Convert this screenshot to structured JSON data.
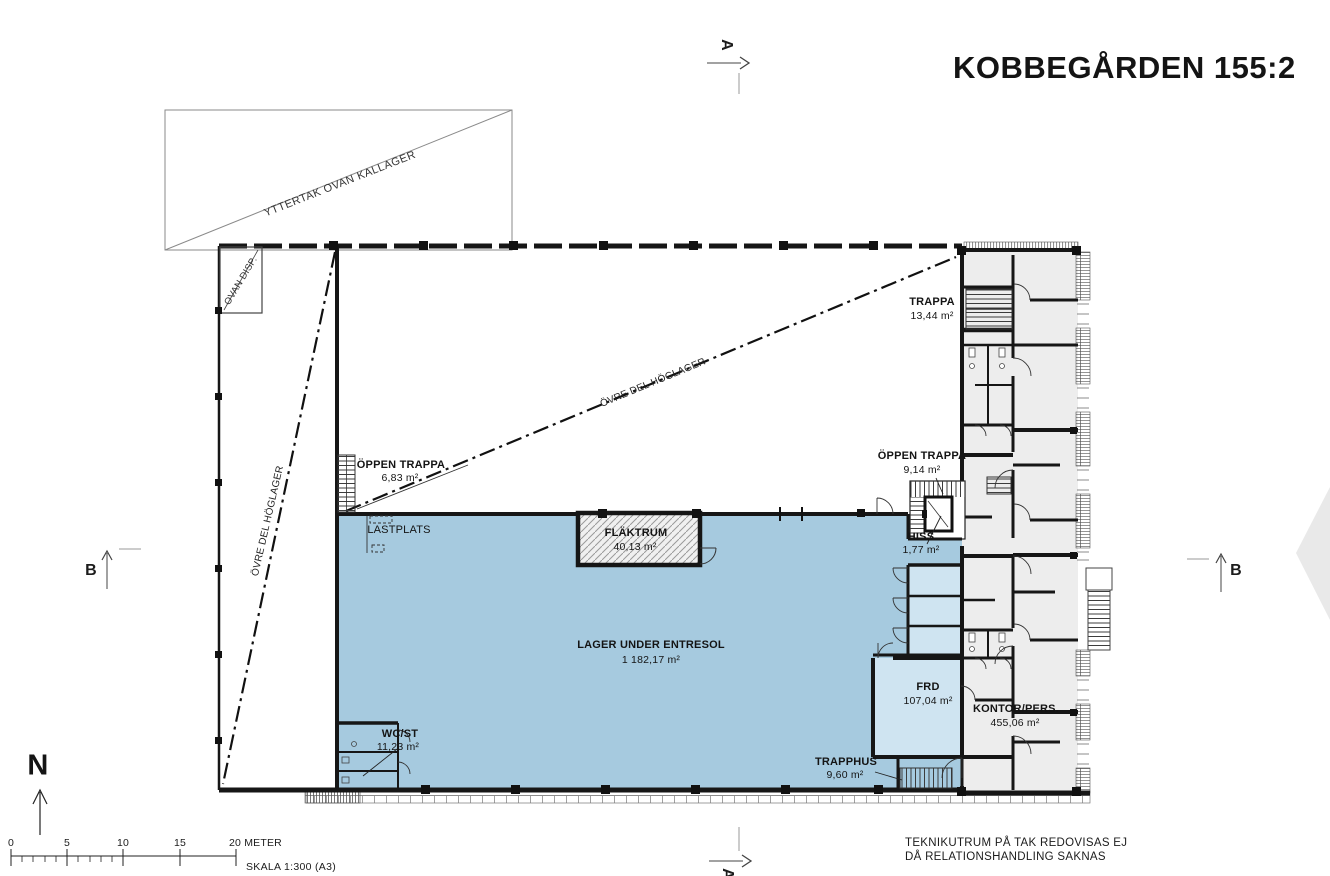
{
  "title": "KOBBEGÅRDEN 155:2",
  "annotations": {
    "roof": "YTTERTAK OVAN KALLAGER",
    "ovan_disp": "OVAN DISP.",
    "hoglager_left": "ÖVRE DEL HÖGLAGER",
    "hoglager_diag": "ÖVRE DEL HÖGLAGER",
    "lastplats": "LASTPLATS"
  },
  "rooms": {
    "trappa": {
      "name": "TRAPPA",
      "area": "13,44 m²"
    },
    "oppen_trappa_vast": {
      "name": "ÖPPEN TRAPPA",
      "area": "6,83 m²"
    },
    "oppen_trappa_ost": {
      "name": "ÖPPEN TRAPPA",
      "area": "9,14 m²"
    },
    "hiss": {
      "name": "HISS",
      "area": "1,77 m²"
    },
    "flaktrum": {
      "name": "FLÄKTRUM",
      "area": "40,13 m²"
    },
    "lager": {
      "name": "LAGER UNDER ENTRESOL",
      "area": "1 182,17 m²"
    },
    "wc_st": {
      "name": "WC/ST",
      "area": "11,23 m²"
    },
    "frd": {
      "name": "FRD",
      "area": "107,04 m²"
    },
    "kontor": {
      "name": "KONTOR/PERS.",
      "area": "455,06 m²"
    },
    "trapphus": {
      "name": "TRAPPHUS",
      "area": "9,60 m²"
    }
  },
  "markers": {
    "section_a": "A",
    "section_a_bottom": "A",
    "section_b_left": "B",
    "section_b_right": "B",
    "north": "N"
  },
  "scale": {
    "ticks": [
      "0",
      "5",
      "10",
      "15",
      "20 METER"
    ],
    "label": "SKALA 1:300 (A3)"
  },
  "note": {
    "line1": "TEKNIKUTRUM PÅ TAK REDOVISAS EJ",
    "line2": "DÅ RELATIONSHANDLING SAKNAS"
  },
  "colors": {
    "wall": "#161616",
    "entresol_blue": "#a6cadf",
    "room_light_blue": "#cfe4f1",
    "office_gray": "#ededed"
  }
}
